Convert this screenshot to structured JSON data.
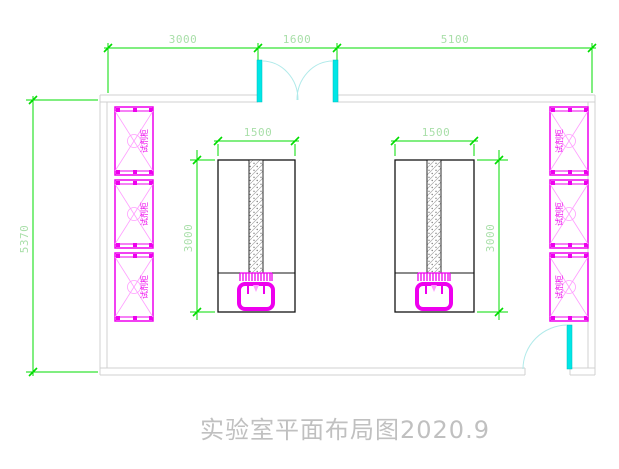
{
  "document": {
    "title": "实验室平面布局图2020.9"
  },
  "dimensions": {
    "top_row": [
      {
        "label": "3000"
      },
      {
        "label": "1600"
      },
      {
        "label": "5100"
      }
    ],
    "room_height": {
      "label": "5370"
    },
    "left_bench": {
      "width": {
        "label": "1500"
      },
      "depth": {
        "label": "3000"
      }
    },
    "right_bench": {
      "width": {
        "label": "1500"
      },
      "depth": {
        "label": "3000"
      }
    }
  },
  "equipment": {
    "cabinet_label": "试剂柜",
    "left_cabinets": [
      "试剂柜",
      "试剂柜",
      "试剂柜"
    ],
    "right_cabinets": [
      "试剂柜",
      "试剂柜",
      "试剂柜"
    ],
    "bench_count": 2,
    "sink_count": 2
  },
  "doors": {
    "top_double_door": "double swing door",
    "bottom_right_door": "single swing door"
  },
  "colors": {
    "dimension-line": "#00dd00",
    "dimension-text": "#a9dfa9",
    "wall": "#d0d0d0",
    "bench-outline": "#141414",
    "cabinet": "#ee00ee",
    "cabinet-detail": "#ff9dff",
    "door": "#00e6e6",
    "door-swing": "#b0eaea",
    "hatch": "#a8a8a8",
    "title-text": "#c0c0c0"
  }
}
